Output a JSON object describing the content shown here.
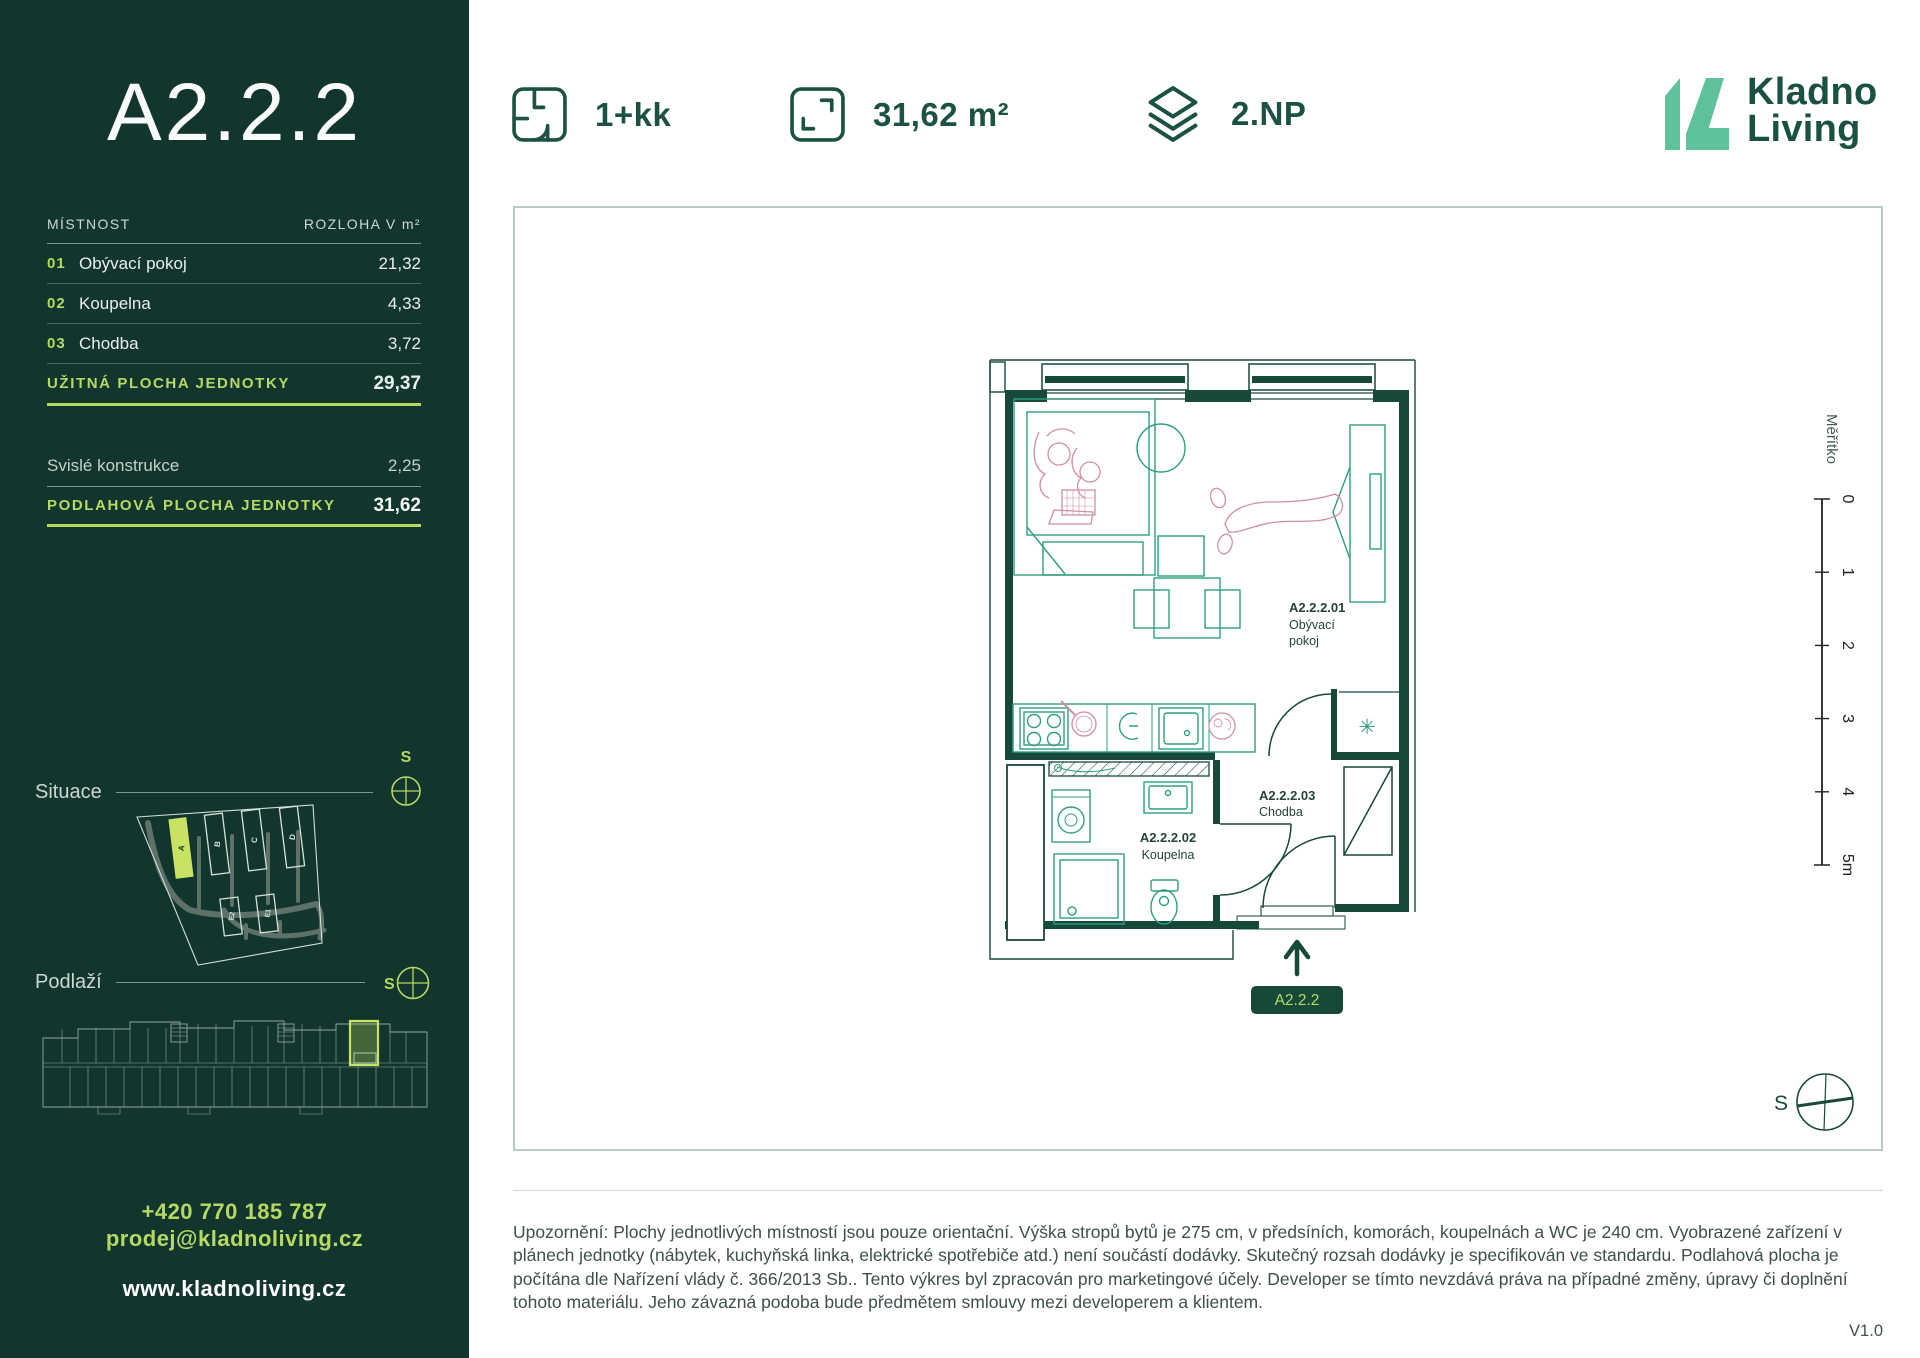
{
  "sidebar": {
    "unit_title": "A2.2.2",
    "table": {
      "col_room": "MÍSTNOST",
      "col_area": "ROZLOHA V m²",
      "rows": [
        {
          "num": "01",
          "name": "Obývací pokoj",
          "area": "21,32"
        },
        {
          "num": "02",
          "name": "Koupelna",
          "area": "4,33"
        },
        {
          "num": "03",
          "name": "Chodba",
          "area": "3,72"
        }
      ],
      "usable_label": "UŽITNÁ PLOCHA JEDNOTKY",
      "usable_value": "29,37",
      "construction_label": "Svislé konstrukce",
      "construction_value": "2,25",
      "floor_label": "PODLAHOVÁ PLOCHA JEDNOTKY",
      "floor_value": "31,62"
    },
    "situace_label": "Situace",
    "situace_compass": "S",
    "site_buildings": [
      "A",
      "B",
      "C",
      "D",
      "E2",
      "E1"
    ],
    "highlighted_building": "A",
    "podlazi_label": "Podlaží",
    "podlazi_compass": "S",
    "phone": "+420 770 185 787",
    "email": "prodej@kladnoliving.cz",
    "website": "www.kladnoliving.cz"
  },
  "header": {
    "disposition": "1+kk",
    "area": "31,62 m²",
    "floor": "2.NP",
    "brand_line1": "Kladno",
    "brand_line2": "Living"
  },
  "plan": {
    "room1_id": "A2.2.2.01",
    "room1_name_l1": "Obývací",
    "room1_name_l2": "pokoj",
    "room2_id": "A2.2.2.02",
    "room2_name": "Koupelna",
    "room3_id": "A2.2.2.03",
    "room3_name": "Chodba",
    "unit_badge": "A2.2.2",
    "ac_symbol": "✳",
    "scale_title": "Měřítko",
    "scale_ticks": [
      "0",
      "1",
      "2",
      "3",
      "4",
      "5m"
    ],
    "compass": "S"
  },
  "footer": {
    "disclaimer": "Upozornění: Plochy jednotlivých místností jsou pouze orientační. Výška stropů bytů je 275 cm, v předsíních, komorách, koupelnách a WC je 240 cm. Vyobrazené zařízení v plánech jednotky (nábytek, kuchyňská linka, elektrické spotřebiče atd.) není součástí dodávky. Skutečný rozsah dodávky je specifikován ve standardu. Podlahová plocha je počítána dle Nařízení vlády č. 366/2013 Sb.. Tento výkres byl zpracován pro marketingové účely. Developer se tímto nevzdává práva na případné změny, úpravy či doplnění tohoto materiálu. Jeho závazná podoba bude předmětem smlouvy mezi developerem a klientem.",
    "version": "V1.0"
  },
  "colors": {
    "sidebar_bg": "#12362d",
    "accent_lime": "#b5d964",
    "highlight_lime": "#c8e262",
    "dark_green": "#17493a",
    "brand_mint": "#5fc19c",
    "teal_furniture": "#2f9e7f",
    "pink_decor": "#cf8fa2"
  }
}
